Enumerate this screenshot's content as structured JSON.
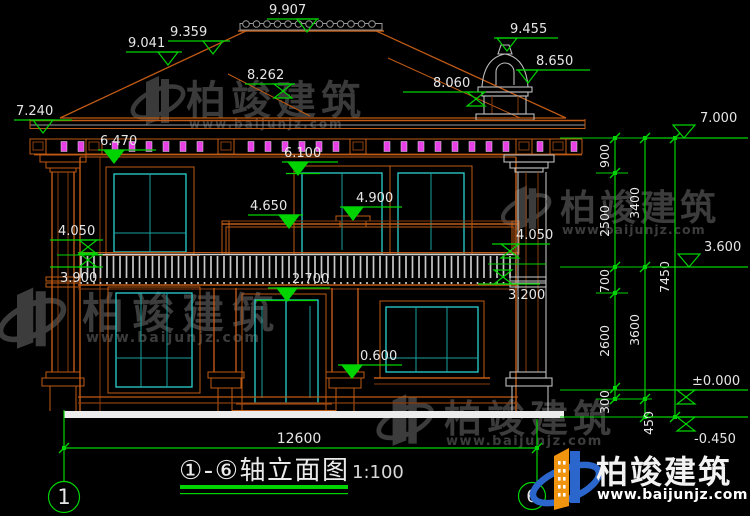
{
  "colors": {
    "background": "#000000",
    "green": "#00d400",
    "orange": "#c05a14",
    "dark_orange": "#8a3c0e",
    "magenta": "#e640e6",
    "cyan": "#2bd0d0",
    "dim_cyan": "#18a0a0",
    "white": "#e6e6e6",
    "gray": "#bdbdbd",
    "tile_gray": "#8f8f8f",
    "ground": "#ececec",
    "watermark_gray": "#4a4a4a",
    "logo_blue": "#2a66cc",
    "logo_orange": "#f0930e"
  },
  "title_block": {
    "title": "①-⑥轴立面图",
    "scale": "1:100"
  },
  "axis_bubbles": [
    {
      "label": "1"
    },
    {
      "label": "6"
    }
  ],
  "watermark": {
    "name": "柏竣建筑",
    "url": "www.baijunjz.com"
  },
  "dimensions": {
    "overall_width": {
      "label": "12600",
      "x1": 64,
      "x2": 537,
      "y": 448,
      "label_x": 299,
      "label_y": 443
    },
    "elevation_markers": [
      {
        "v": "9.041",
        "lx": 126,
        "ly": 52,
        "lw": 56,
        "tx": 168,
        "tri": "down",
        "fill": false
      },
      {
        "v": "9.359",
        "lx": 168,
        "ly": 41,
        "lw": 62,
        "tx": 213,
        "tri": "down",
        "fill": false
      },
      {
        "v": "9.907",
        "lx": 267,
        "ly": 19,
        "lw": 52,
        "tx": 307,
        "tri": "down",
        "fill": false
      },
      {
        "v": "8.262",
        "lx": 245,
        "ly": 84,
        "lw": 50,
        "tx": 283,
        "tri": "zero",
        "fill": false
      },
      {
        "v": "8.060",
        "lx": 403,
        "ly": 92,
        "lw": 70,
        "tx": 476,
        "tri": "zero",
        "fill": false,
        "dx": 30
      },
      {
        "v": "9.455",
        "lx": 494,
        "ly": 38,
        "lw": 64,
        "tx": 507,
        "tri": "down",
        "fill": false,
        "dx": 16
      },
      {
        "v": "8.650",
        "lx": 516,
        "ly": 70,
        "lw": 74,
        "tx": 528,
        "tri": "down",
        "fill": false,
        "dx": 20
      },
      {
        "v": "7.240",
        "lx": 14,
        "ly": 120,
        "lw": 58,
        "tx": 43,
        "tri": "down",
        "fill": false
      },
      {
        "v": "6.470",
        "lx": 98,
        "ly": 150,
        "lw": 58,
        "tx": 114,
        "tri": "down",
        "fill": true
      },
      {
        "v": "6.100",
        "lx": 282,
        "ly": 162,
        "lw": 56,
        "tx": 298,
        "tri": "down",
        "fill": true
      },
      {
        "v": "4.900",
        "lx": 340,
        "ly": 207,
        "lw": 62,
        "tx": 353,
        "tri": "down",
        "fill": true,
        "dx": 16
      },
      {
        "v": "4.650",
        "lx": 248,
        "ly": 215,
        "lw": 55,
        "tx": 289,
        "tri": "down",
        "fill": true
      },
      {
        "v": "4.050",
        "lx": 50,
        "ly": 240,
        "lw": 53,
        "tx": 88,
        "tri": "zero",
        "fill": false,
        "dx": 8
      },
      {
        "v": "4.050",
        "lx": 492,
        "ly": 244,
        "lw": 58,
        "tx": 510,
        "tri": "zero",
        "fill": false,
        "dx": 24
      },
      {
        "v": "3.900",
        "lx": 50,
        "ly": 267,
        "lw": 53,
        "tx": 88,
        "tri": "zup",
        "fill": false,
        "pos": "below",
        "dx": 10
      },
      {
        "v": "2.700",
        "lx": 268,
        "ly": 288,
        "lw": 62,
        "tx": 287,
        "tri": "down",
        "fill": true,
        "dx": 24
      },
      {
        "v": "3.200",
        "lx": 478,
        "ly": 284,
        "lw": 62,
        "tx": 503,
        "tri": "zup",
        "fill": false,
        "pos": "below",
        "dx": 30
      },
      {
        "v": "0.600",
        "lx": 338,
        "ly": 365,
        "lw": 64,
        "tx": 352,
        "tri": "down",
        "fill": true,
        "dx": 22
      },
      {
        "v": "7.000",
        "lx": 646,
        "ly": 138,
        "lw": 102,
        "tx": 684,
        "tri": "up",
        "fill": false,
        "dx": 54
      },
      {
        "v": "3.600",
        "lx": 652,
        "ly": 267,
        "lw": 96,
        "tx": 689,
        "tri": "up",
        "fill": false,
        "dx": 52
      },
      {
        "v": "±0.000",
        "lx": 648,
        "ly": 390,
        "lw": 100,
        "tx": 686,
        "tri": "zero",
        "fill": false,
        "dx": 44
      },
      {
        "v": "-0.450",
        "lx": 648,
        "ly": 417,
        "lw": 100,
        "tx": 686,
        "tri": "zero",
        "fill": false,
        "pos": "below",
        "dx": 46
      }
    ],
    "chains": [
      {
        "x": 615,
        "y1": 138,
        "y2": 399,
        "ticks": [
          138,
          173,
          267,
          293,
          388,
          399
        ],
        "labels": [
          [
            "900",
            156
          ],
          [
            "2500",
            221
          ],
          [
            "700",
            281
          ],
          [
            "2600",
            341
          ],
          [
            "300",
            402
          ]
        ]
      },
      {
        "x": 645,
        "y1": 138,
        "y2": 417,
        "ticks": [
          138,
          267,
          399,
          417
        ],
        "labels": [
          [
            "3400",
            203
          ],
          [
            "3600",
            330
          ],
          [
            "450",
            423,
            14
          ]
        ]
      },
      {
        "x": 675,
        "y1": 138,
        "y2": 417,
        "ticks": [
          138,
          417
        ],
        "labels": [
          [
            "7450",
            277
          ]
        ]
      }
    ],
    "chain_guides": [
      [
        560,
        138,
        746
      ],
      [
        596,
        173,
        628
      ],
      [
        560,
        267,
        746
      ],
      [
        596,
        293,
        628
      ],
      [
        560,
        390,
        682
      ],
      [
        596,
        399,
        652
      ],
      [
        560,
        417,
        682
      ],
      [
        57,
        255,
        103
      ],
      [
        488,
        264,
        546
      ]
    ]
  }
}
